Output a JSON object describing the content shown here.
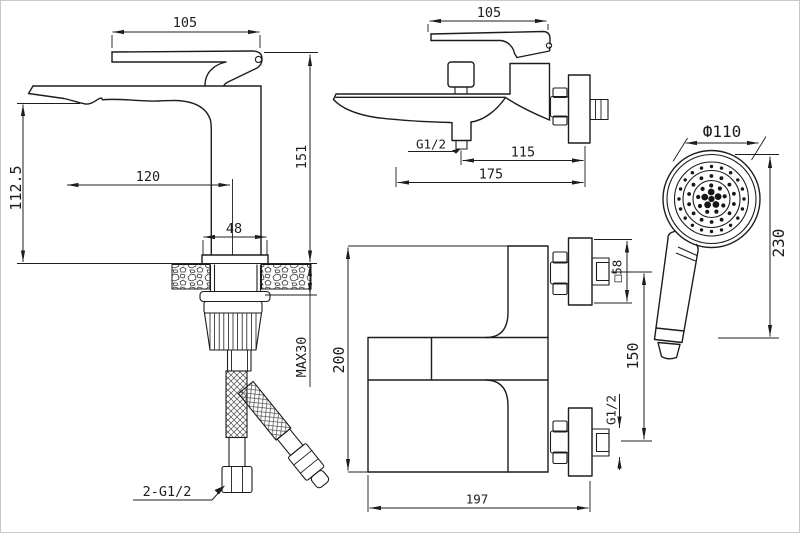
{
  "basin": {
    "dim_lever": "105",
    "dim_height": "151",
    "dim_spout_height": "112.5",
    "dim_reach": "120",
    "dim_base_width": "48",
    "dim_max_counter": "MAX30",
    "label_inlet_hoses": "2-G1/2"
  },
  "bath_side": {
    "dim_lever": "105",
    "label_spout_outlet": "G1/2",
    "dim_outlet_to_wall": "115",
    "dim_spout_to_wall": "175"
  },
  "bath_front": {
    "dim_height": "200",
    "dim_width": "197",
    "dim_inlet_centers": "150",
    "dim_escutcheon": "□58",
    "label_inlet_thread": "G1/2"
  },
  "shower": {
    "dim_head_diameter": "Ф110",
    "dim_length": "230"
  },
  "style": {
    "line_color": "#1d1d1d",
    "background": "#ffffff",
    "frame_color": "#c9c9c9"
  }
}
